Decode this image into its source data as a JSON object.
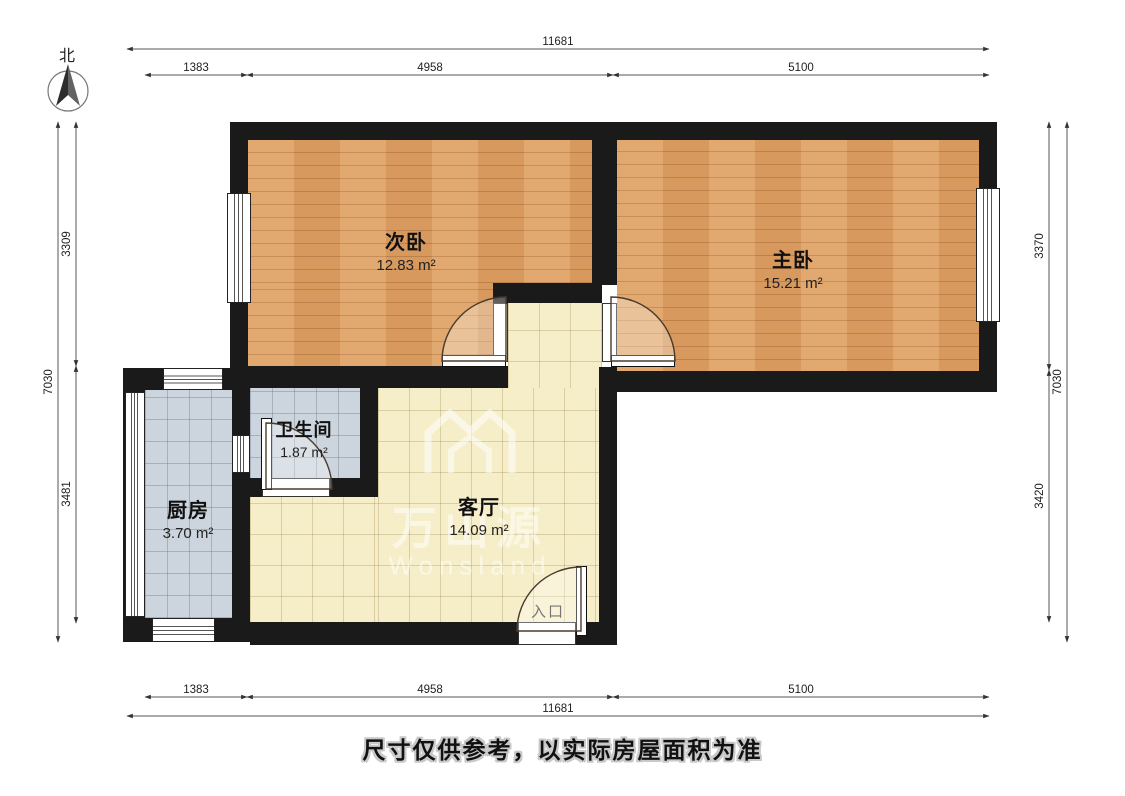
{
  "compass": {
    "label": "北"
  },
  "dims": {
    "top": {
      "total": "11681",
      "segments": [
        "1383",
        "4958",
        "5100"
      ]
    },
    "bottom": {
      "total": "11681",
      "segments": [
        "1383",
        "4958",
        "5100"
      ]
    },
    "left": {
      "total": "7030",
      "segments": [
        "3309",
        "3481"
      ]
    },
    "right": {
      "total": "7030",
      "segments": [
        "3370",
        "3420"
      ]
    }
  },
  "rooms": {
    "bed2": {
      "name": "次卧",
      "area": "12.83 m²"
    },
    "bed1": {
      "name": "主卧",
      "area": "15.21 m²"
    },
    "bath": {
      "name": "卫生间",
      "area": "1.87 m²"
    },
    "kitchen": {
      "name": "厨房",
      "area": "3.70 m²"
    },
    "living": {
      "name": "客厅",
      "area": "14.09 m²"
    }
  },
  "entrance": {
    "label": "入口"
  },
  "watermark": {
    "cn": "万山源",
    "en": "Wonsland"
  },
  "footer": {
    "disclaimer": "尺寸仅供参考，以实际房屋面积为准"
  },
  "colors": {
    "wall": "#1a1a1a",
    "wood_floor": "#dfa164",
    "tile_cream": "#f6eec9",
    "tile_blue": "#ccd4dd",
    "dim_line": "#444444"
  }
}
